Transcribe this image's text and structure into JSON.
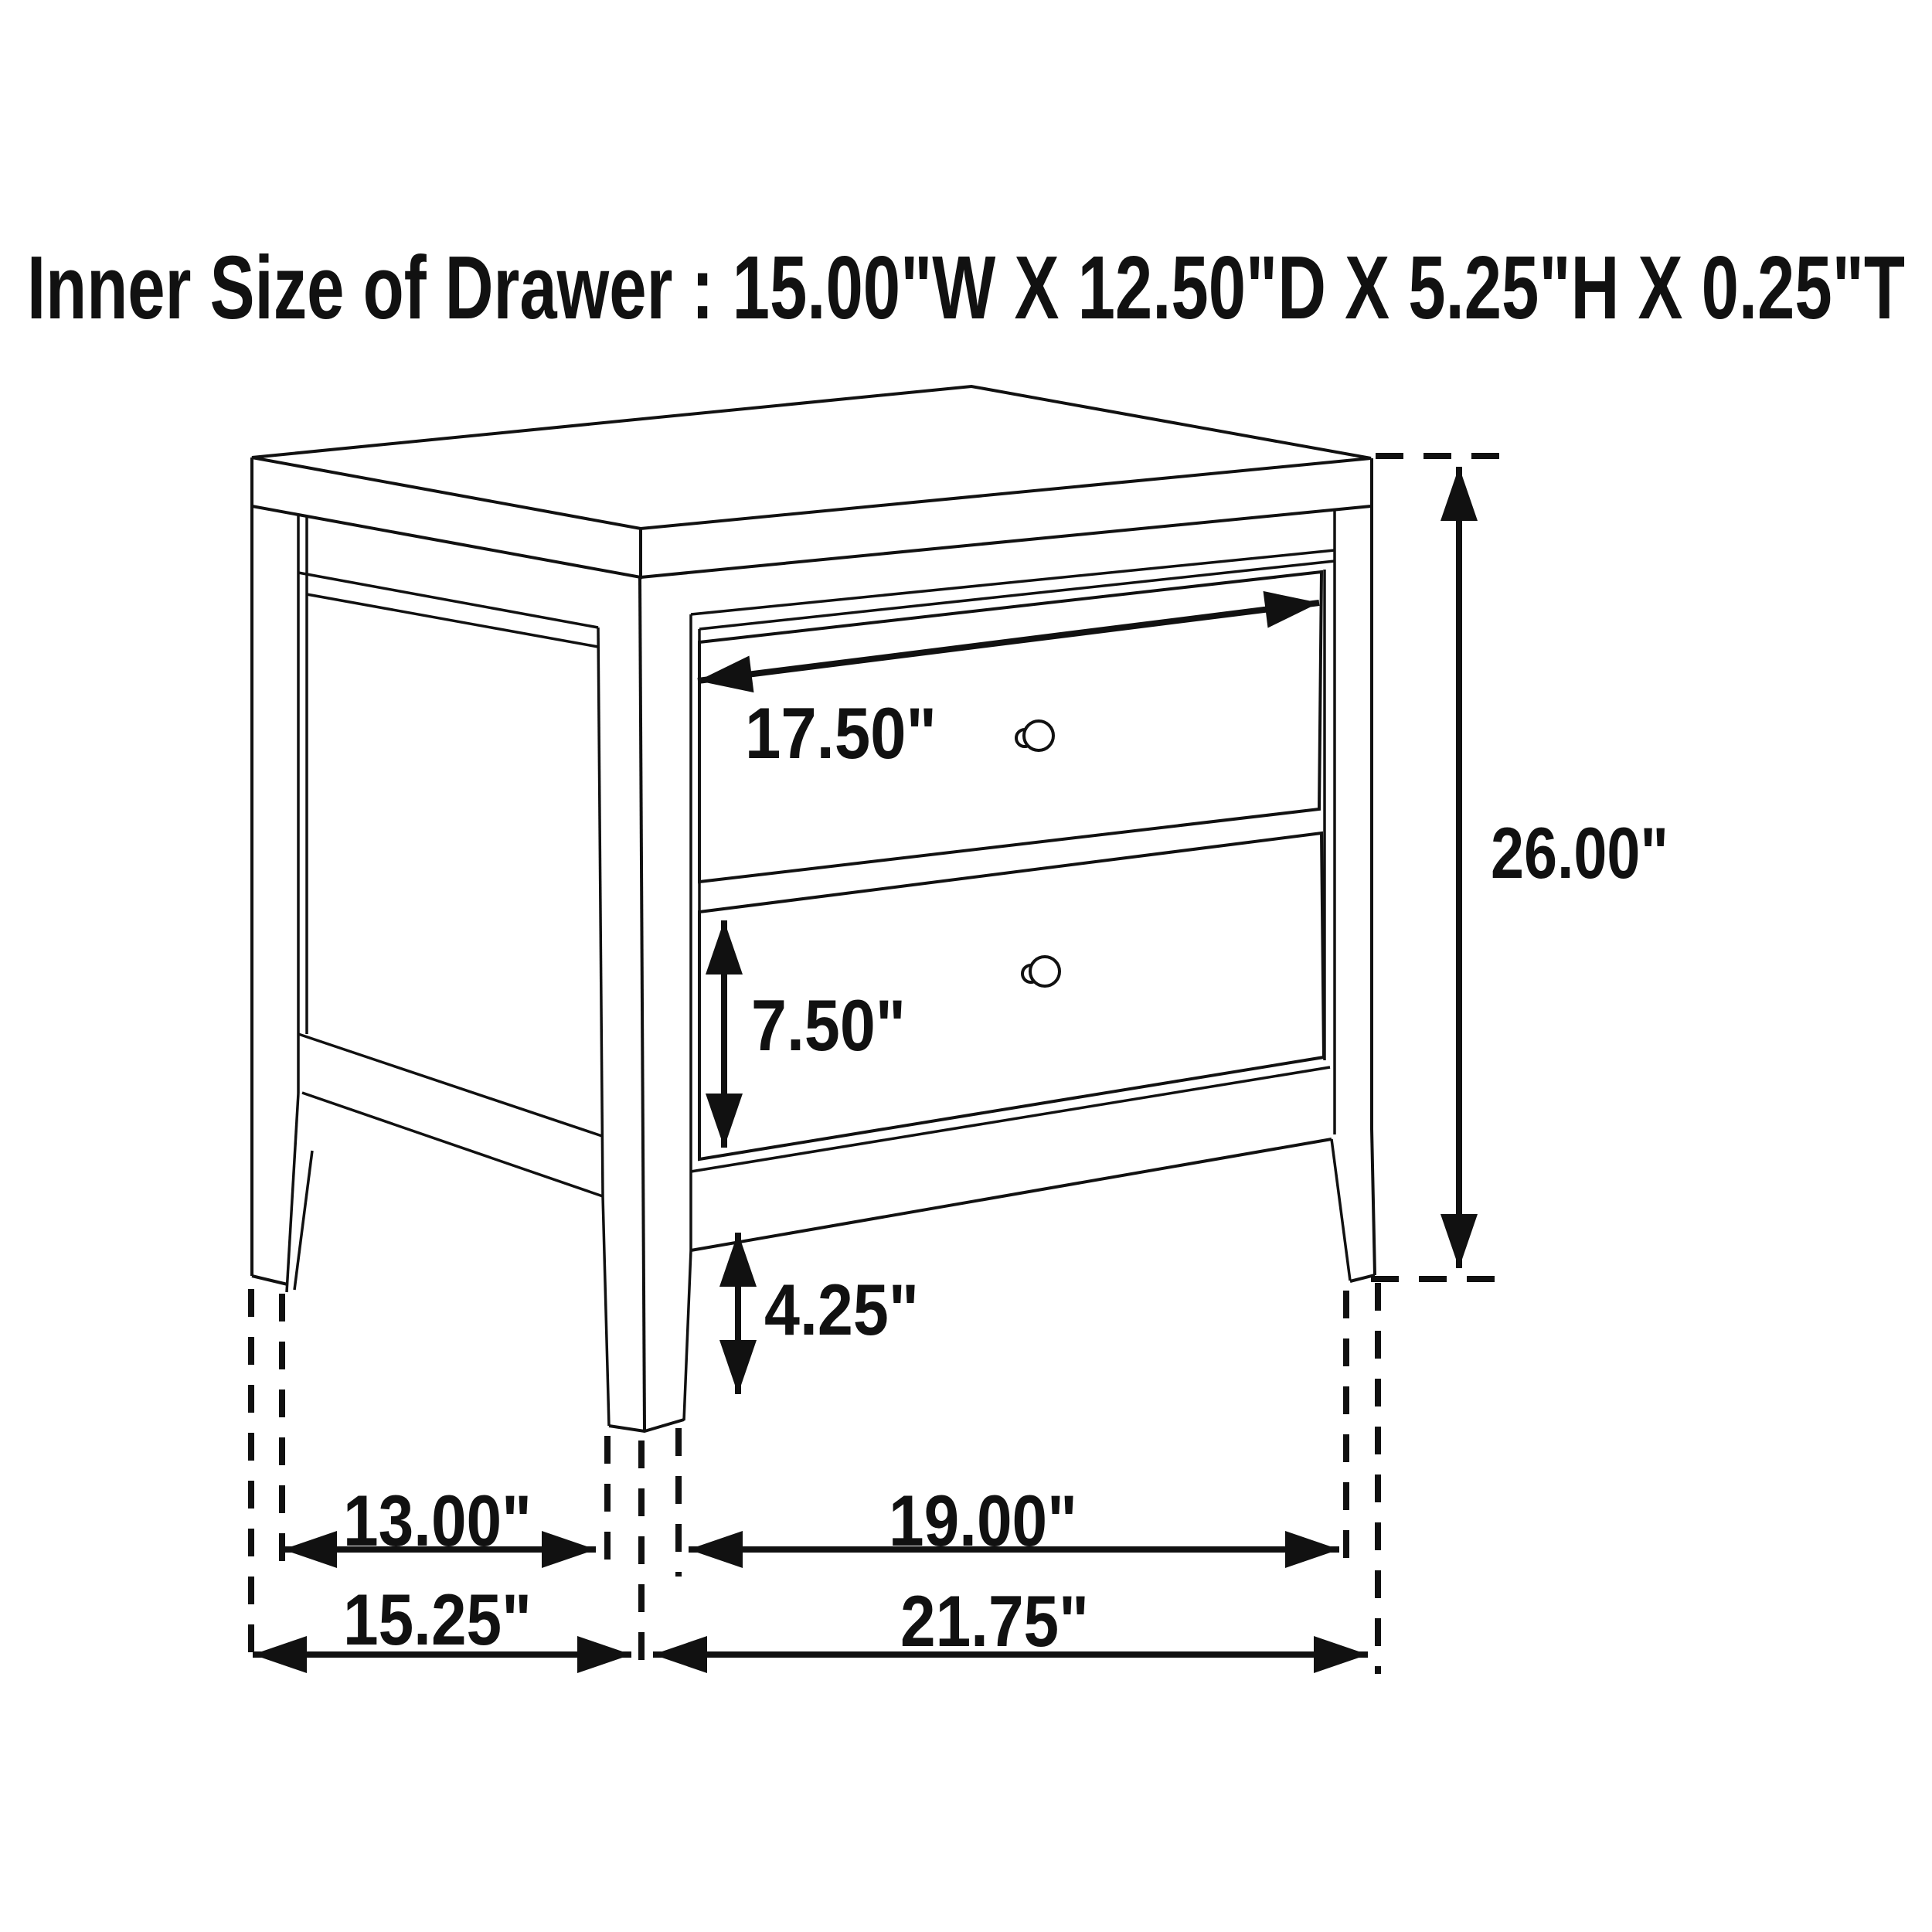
{
  "title": "Inner Size of Drawer : 15.00\"W X 12.50\"D X 5.25\"H X 0.25\"T",
  "diagram_type": "furniture-dimension-drawing",
  "subject": "two-drawer nightstand",
  "colors": {
    "line": "#111111",
    "background": "#ffffff"
  },
  "dimensions": {
    "drawer_face_width": "17.50\"",
    "overall_height": "26.00\"",
    "bottom_drawer_height": "7.50\"",
    "leg_height": "4.25\"",
    "side_leg_spacing_inner": "13.00\"",
    "front_leg_spacing_inner": "19.00\"",
    "side_depth_overall": "15.25\"",
    "front_width_overall": "21.75\""
  }
}
